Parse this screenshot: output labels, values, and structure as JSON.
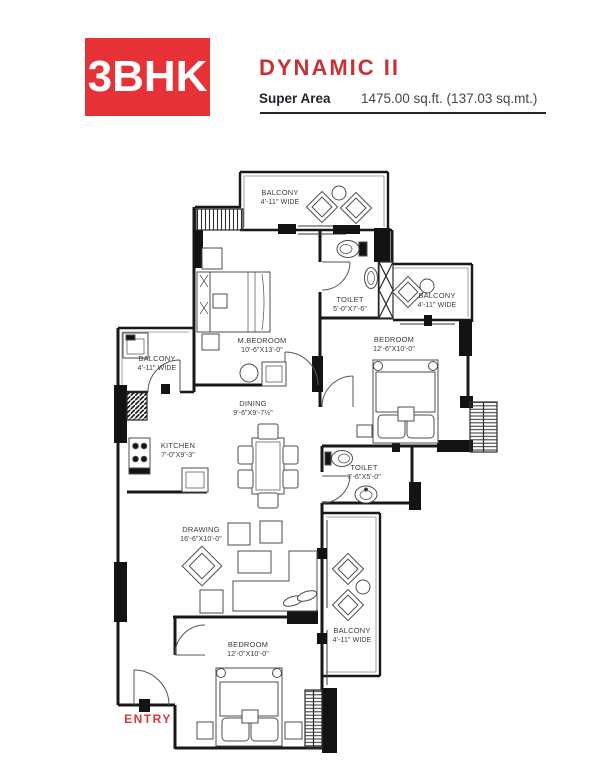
{
  "header": {
    "badge": "3BHK",
    "title": "DYNAMIC II",
    "super_area_label": "Super Area",
    "super_area_value": "1475.00 sq.ft. (137.03 sq.mt.)",
    "accent_color": "#e63137",
    "title_color": "#c93137",
    "text_dark": "#23232d"
  },
  "floor_plan": {
    "entry_label": "ENTRY",
    "entry_color": "#d6363c",
    "rooms": [
      {
        "id": "balcony-top",
        "name": "BALCONY",
        "dims": "4'-11\" WIDE"
      },
      {
        "id": "m-bedroom",
        "name": "M.BEDROOM",
        "dims": "10'-6\"X13'-0\""
      },
      {
        "id": "toilet-top",
        "name": "TOILET",
        "dims": "5'-0\"X7'-6\""
      },
      {
        "id": "balcony-right",
        "name": "BALCONY",
        "dims": "4'-11\" WIDE"
      },
      {
        "id": "bedroom-right",
        "name": "BEDROOM",
        "dims": "12'-6\"X10'-0\""
      },
      {
        "id": "balcony-left",
        "name": "BALCONY",
        "dims": "4'-11\" WIDE"
      },
      {
        "id": "kitchen",
        "name": "KITCHEN",
        "dims": "7'-0\"X9'-3\""
      },
      {
        "id": "dining",
        "name": "DINING",
        "dims": "9'-6\"X9'-7½\""
      },
      {
        "id": "toilet-mid",
        "name": "TOILET",
        "dims": "7'-6\"X5'-0\""
      },
      {
        "id": "drawing",
        "name": "DRAWING",
        "dims": "16'-6\"X10'-0\""
      },
      {
        "id": "bedroom-bottom",
        "name": "BEDROOM",
        "dims": "12'-0\"X10'-0\""
      },
      {
        "id": "balcony-bottom",
        "name": "BALCONY",
        "dims": "4'-11\" WIDE"
      }
    ]
  }
}
